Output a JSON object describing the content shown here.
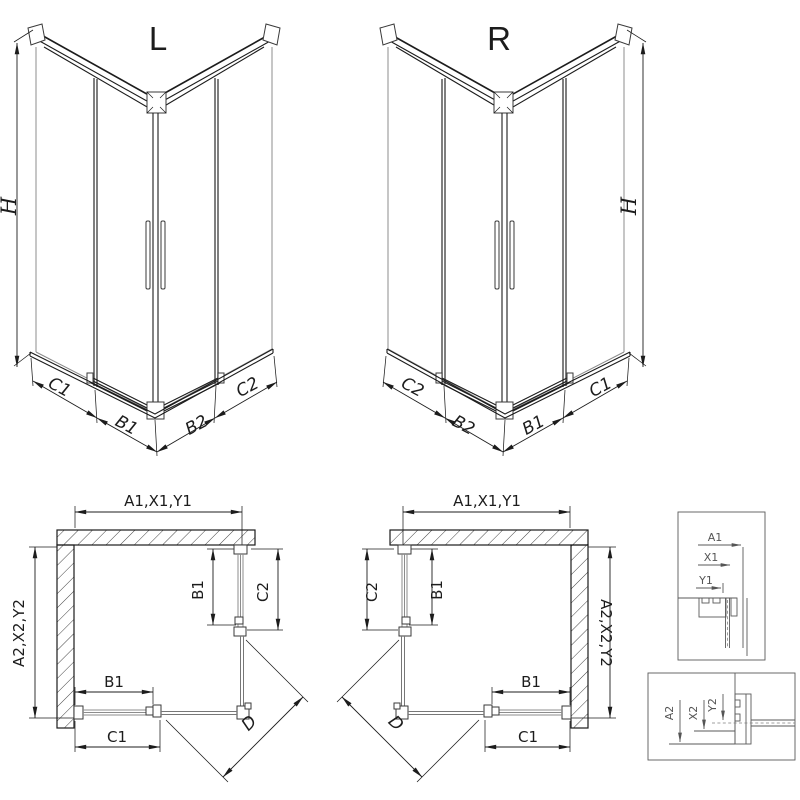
{
  "colors": {
    "line": "#1c1c1c",
    "glass_line": "#8c8c8c",
    "profile_line": "#3a3a3a",
    "detail_line": "#5a5a5a",
    "background": "#ffffff"
  },
  "iso_left": {
    "title": "L",
    "height_dim": "H",
    "dim_outer_left": "C1",
    "dim_inner_left": "B1",
    "dim_inner_right": "B2",
    "dim_outer_right": "C2"
  },
  "iso_right": {
    "title": "R",
    "height_dim": "H",
    "dim_outer_left": "C2",
    "dim_inner_left": "B2",
    "dim_inner_right": "B1",
    "dim_outer_right": "C1"
  },
  "plan_left": {
    "width_dim": "A1,X1,Y1",
    "depth_dim": "A2,X2,Y2",
    "side_door_dim": "B1",
    "side_outer_dim": "C2",
    "front_door_dim": "B1",
    "front_outer_dim": "C1",
    "diagonal_dim": "D"
  },
  "plan_right": {
    "width_dim": "A1,X1,Y1",
    "depth_dim": "A2,X2,Y2",
    "side_door_dim": "B1",
    "side_outer_dim": "C2",
    "front_door_dim": "B1",
    "front_outer_dim": "C1",
    "diagonal_dim": "D"
  },
  "detail_top": {
    "dims": [
      "A1",
      "X1",
      "Y1"
    ]
  },
  "detail_bottom": {
    "dims": [
      "A2",
      "X2",
      "Y2"
    ]
  }
}
